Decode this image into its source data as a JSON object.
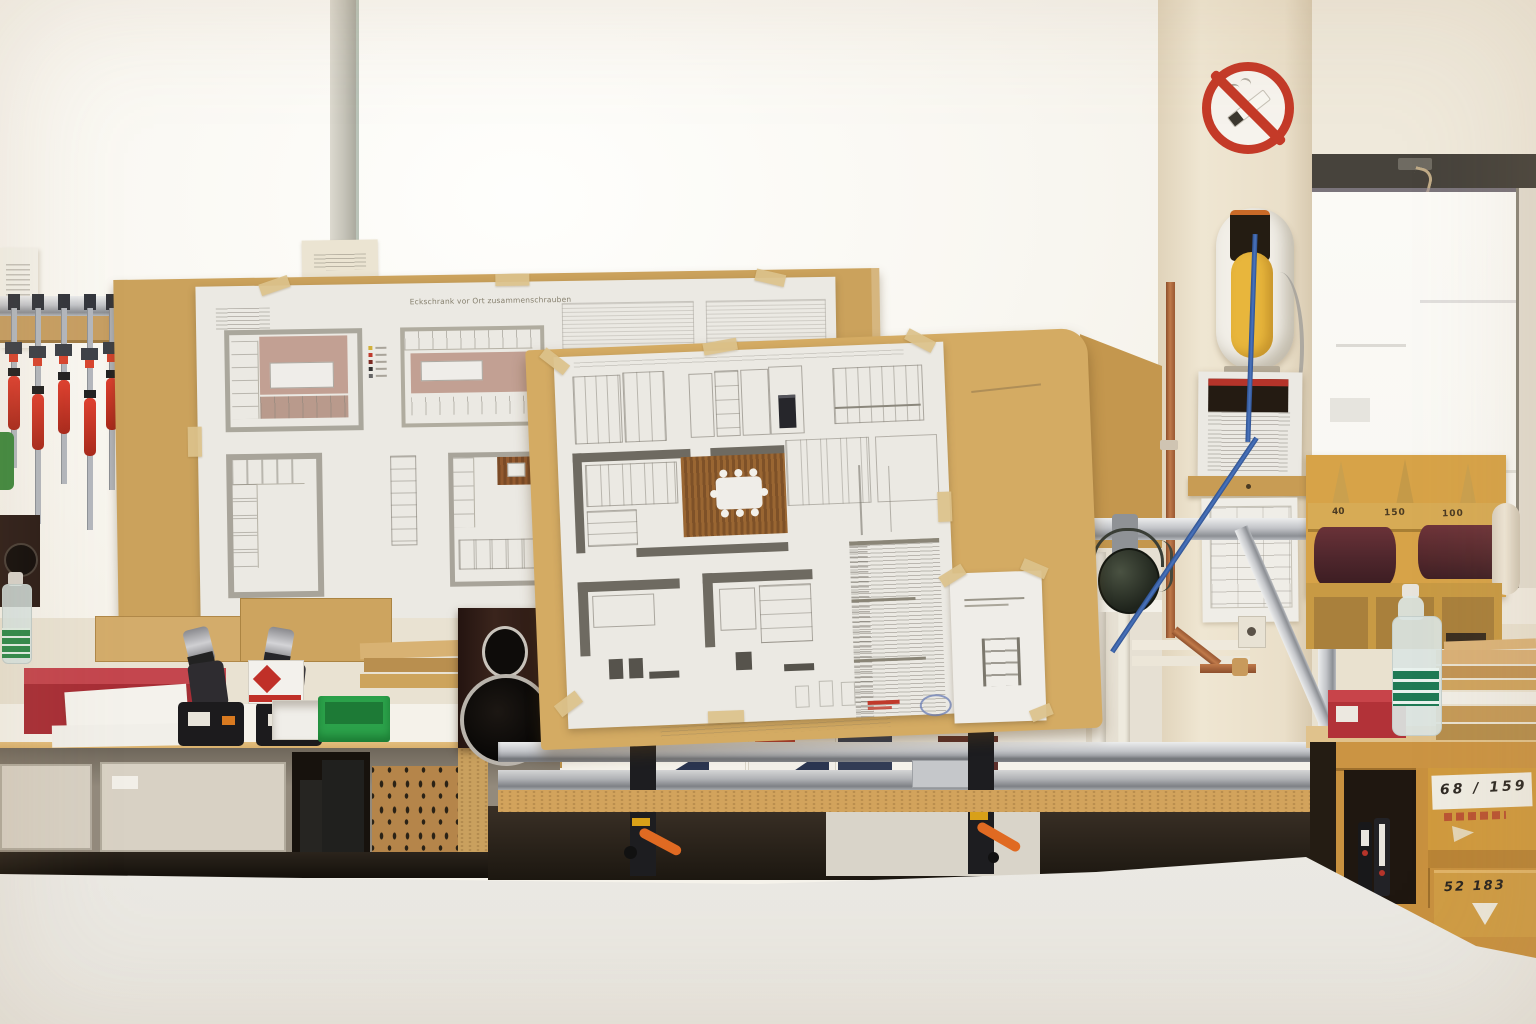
{
  "scene": {
    "description": "Carpentry workshop: kitchen construction blueprints taped to MDF boards, workbench with cordless drills, clamp rack, speaker, sandpaper dispenser, no-smoking sign on pillar, white assembly table in foreground"
  },
  "left_blueprint": {
    "title": "Eckschrank vor Ort zusammenschrauben"
  },
  "sandpaper": {
    "grits": [
      "40",
      "150",
      "100"
    ]
  },
  "shelf_boxes": {
    "upper_label": "68 / 159",
    "lower_label": "52  183"
  },
  "icons": {
    "no_smoking_sign": "red prohibition circle with diagonal bar over a cigarette"
  },
  "colors": {
    "board_tan": "#d4ab63",
    "board_tan_dark": "#cba25c",
    "blueprint_paper": "#ebe9e3",
    "no_smoking_red": "#c43a28",
    "clamp_handle_red": "#d13c2c",
    "green_box": "#2ba14a",
    "blue_cable": "#3a67b2",
    "shelf_wood": "#c8913f",
    "sandpaper_maroon": "#53262b"
  }
}
